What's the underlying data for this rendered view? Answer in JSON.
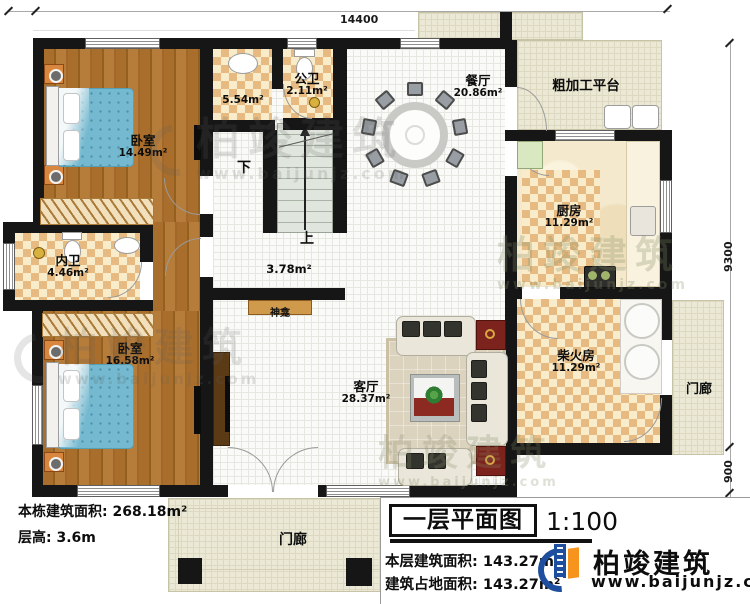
{
  "plan": {
    "dimensions": {
      "top": "14400",
      "right": "9300",
      "right_step": "900",
      "right_porch": "2000"
    },
    "rooms": [
      {
        "label": "卧室",
        "area": "14.49m²"
      },
      {
        "label": "",
        "area": "5.54m²"
      },
      {
        "label": "公卫",
        "area": "2.11m²"
      },
      {
        "label": "餐厅",
        "area": "20.86m²"
      },
      {
        "label": "粗加工平台",
        "area": ""
      },
      {
        "label": "厨房",
        "area": "11.29m²"
      },
      {
        "label": "内卫",
        "area": "4.46m²"
      },
      {
        "label": "卧室",
        "area": "16.58m²"
      },
      {
        "label": "",
        "area": "3.78m²"
      },
      {
        "label": "客厅",
        "area": "28.37m²"
      },
      {
        "label": "柴火房",
        "area": "11.29m²"
      },
      {
        "label": "门廊",
        "area": ""
      },
      {
        "label": "门廊",
        "area": ""
      }
    ],
    "stairs": {
      "up": "上",
      "down": "下"
    },
    "shrine": "神龛"
  },
  "notes": {
    "total_label": "本栋建筑面积:",
    "total_value": "268.18m²",
    "height_label": "层高:",
    "height_value": "3.6m"
  },
  "title_block": {
    "title": "一层平面图",
    "scale": "1:100",
    "row1_label": "本层建筑面积:",
    "row1_value": "143.27m²",
    "row2_label": "建筑占地面积:",
    "row2_value": "143.27m²"
  },
  "brand": {
    "name": "柏竣建筑",
    "url": "www.baijunjz.com"
  },
  "watermark": {
    "name": "柏竣建筑",
    "url": "www.baijunjz.com"
  },
  "colors": {
    "wall": "#161616",
    "brand_blue": "#1d4f9e",
    "brand_orange": "#f7941d"
  }
}
